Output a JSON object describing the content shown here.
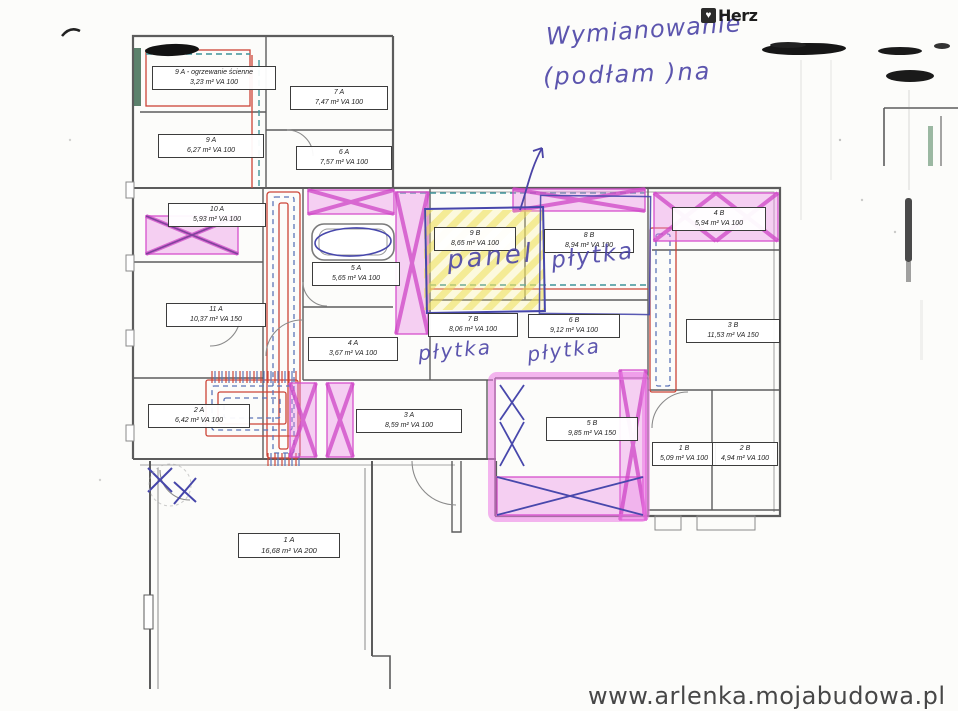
{
  "branding": {
    "logo_text": "Herz",
    "logo_icon": "heart-icon"
  },
  "watermark": {
    "text": "www.arlenka.mojabudowa.pl"
  },
  "annotations": {
    "title_line1": "Wymianowanie",
    "title_line2": "(podłam )na",
    "panel_label": "panel",
    "tile_label_8b": "płytka",
    "tile_label_7b": "płytka",
    "tile_label_6b": "płytka"
  },
  "colors": {
    "highlight_pink": "#d650cd",
    "highlight_yellow": "#f0e15a",
    "pipe_red": "#cc4437",
    "pipe_blue": "#5b74b8",
    "pipe_teal": "#3f949a",
    "ink_blue": "#4b44a6",
    "wall_gray": "#5c5c5c",
    "wall_heating_green": "#3f6b52"
  },
  "rooms": [
    {
      "id": "9A-wall",
      "line1": "9 A - ogrzewanie ścienne",
      "line2": "3,23 m² VA 100"
    },
    {
      "id": "7A",
      "line1": "7 A",
      "line2": "7,47 m² VA 100"
    },
    {
      "id": "9A",
      "line1": "9 A",
      "line2": "6,27 m² VA 100"
    },
    {
      "id": "6A",
      "line1": "6 A",
      "line2": "7,57 m² VA 100"
    },
    {
      "id": "10A",
      "line1": "10 A",
      "line2": "5,93 m² VA 100"
    },
    {
      "id": "5A",
      "line1": "5 A",
      "line2": "5,65 m² VA 100"
    },
    {
      "id": "11A",
      "line1": "11 A",
      "line2": "10,37 m² VA 150"
    },
    {
      "id": "4A",
      "line1": "4 A",
      "line2": "3,67 m² VA 100"
    },
    {
      "id": "2A",
      "line1": "2 A",
      "line2": "6,42 m² VA 100"
    },
    {
      "id": "3A",
      "line1": "3 A",
      "line2": "8,59 m² VA 100"
    },
    {
      "id": "1A",
      "line1": "1 A",
      "line2": "16,68 m² VA 200"
    },
    {
      "id": "9B",
      "line1": "9 B",
      "line2": "8,65 m² VA 100"
    },
    {
      "id": "8B",
      "line1": "8 B",
      "line2": "8,94 m² VA 100"
    },
    {
      "id": "7B",
      "line1": "7 B",
      "line2": "8,06 m² VA 100"
    },
    {
      "id": "6B",
      "line1": "6 B",
      "line2": "9,12 m² VA 100"
    },
    {
      "id": "4B",
      "line1": "4 B",
      "line2": "5,94 m² VA 100"
    },
    {
      "id": "3B",
      "line1": "3 B",
      "line2": "11,53 m² VA 150"
    },
    {
      "id": "5B",
      "line1": "5 B",
      "line2": "9,85 m² VA 150"
    },
    {
      "id": "1B",
      "line1": "1 B",
      "line2": "5,09 m² VA 100"
    },
    {
      "id": "2B",
      "line1": "2 B",
      "line2": "4,94 m² VA 100"
    }
  ]
}
